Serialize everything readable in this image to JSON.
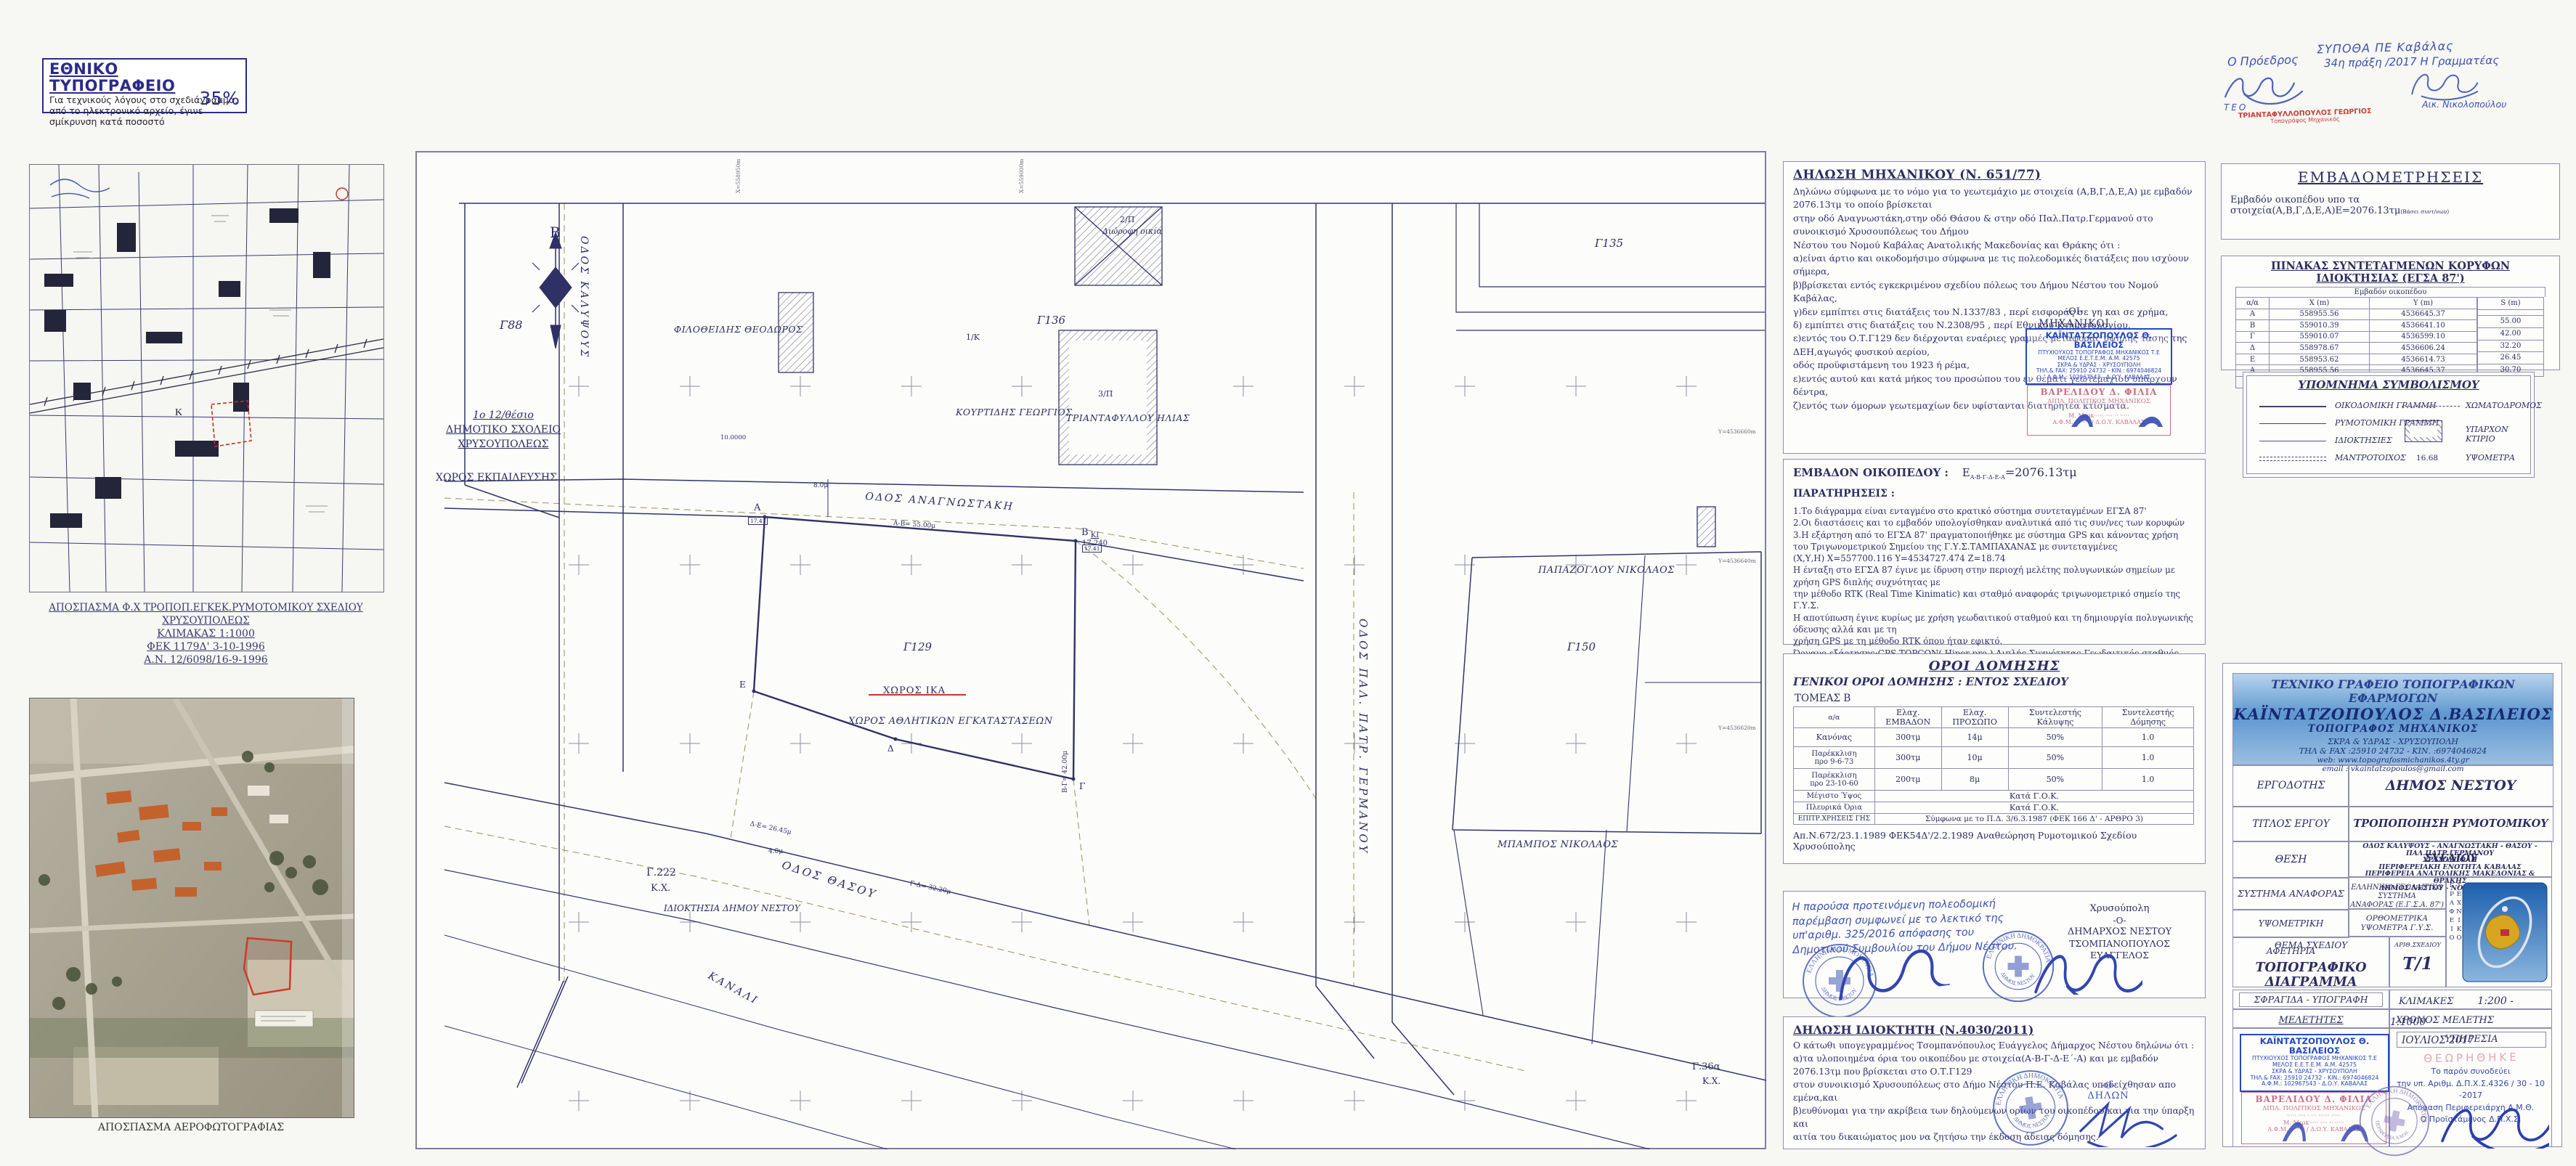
{
  "stamp_note": {
    "title": "ΕΘΝΙΚΟ ΤΥΠΟΓΡΑΦΕΙΟ",
    "line1": "Για τεχνικούς λόγους στο σχεδιάγραμμα,",
    "line2": "από το ηλεκτρονικό αρχείο, έγινε",
    "line3": "σμίκρυνση κατά ποσοστό",
    "percent": "35%"
  },
  "approval": {
    "committee": "ΣΥΠΟΘΑ ΠΕ Καβάλας",
    "act": "34η πράξη /2017 Η Γραμματέας",
    "secretary": "Αικ. Νικολοπούλου",
    "president": "Ο Πρόεδρος",
    "teo": "ΤΕΟ",
    "stamp_name": "ΤΡΙΑΝΤΑΦΥΛΛΟΠΟΥΛΟΣ ΓΕΩΡΓΙΟΣ",
    "stamp_title": "Τοπογράφος Μηχανικός"
  },
  "inset": {
    "caption1": "ΑΠΟΣΠΑΣΜΑ Φ.Χ ΤΡΟΠΟΠ.ΕΓΚΕΚ.ΡΥΜΟΤΟΜΙΚΟΥ ΣΧΕΔΙΟΥ ΧΡΥΣΟΥΠΟΛΕΩΣ",
    "caption2": "ΚΛΙΜΑΚΑΣ 1:1000",
    "caption3": "ΦΕΚ 1179Δ' 3-10-1996",
    "caption4": "Α.Ν. 12/6098/16-9-1996"
  },
  "aerial": {
    "caption": "ΑΠΟΣΠΑΣΜΑ ΑΕΡΟΦΩΤΟΓΡΑΦΙΑΣ"
  },
  "map": {
    "north": "Β",
    "streets": {
      "kalypsous": "ΟΔΟΣ ΚΑΛΥΨΟΥΣ",
      "anagnostaki": "ΟΔΟΣ ΑΝΑΓΝΩΣΤΑΚΗ",
      "thasou": "ΟΔΟΣ ΘΑΣΟΥ",
      "germanou": "ΟΔΟΣ ΠΑΛ. ΠΑΤΡ. ΓΕΡΜΑΝΟΥ",
      "kanali": "ΚΑΝΑΛΙ"
    },
    "blocks": {
      "g88": "Γ88",
      "g129": "Γ129",
      "g135": "Γ135",
      "g136": "Γ136",
      "g150": "Γ150",
      "g222": "Γ.222",
      "g222kx": "Κ.Χ.",
      "g36a": "Γ.36α",
      "g36kx": "Κ.Χ."
    },
    "school": {
      "l1": "1ο 12/θέσιο",
      "l2": "ΔΗΜΟΤΙΚΟ ΣΧΟΛΕΙΟ",
      "l3": "ΧΡΥΣΟΥΠΟΛΕΩΣ",
      "l4": "ΧΩΡΟΣ ΕΚΠΑΙΔΕΥΣΗΣ"
    },
    "owners": {
      "filotheidis": "ΦΙΛΟΘΕΙΔΗΣ ΘΕΟΔΩΡΟΣ",
      "kourtidis": "ΚΟΥΡΤΙΔΗΣ ΓΕΩΡΓΙΟΣ",
      "triantafyllou": "ΤΡΙΑΝΤΑΦΥΛΛΟΥ ΗΛΙΑΣ",
      "papazoglou": "ΠΑΠΑΖΟΓΛΟΥ ΝΙΚΟΛΑΟΣ",
      "mpampos": "ΜΠΑΜΠΟΣ ΝΙΚΟΛΑΟΣ"
    },
    "uses": {
      "ika": "ΧΩΡΟΣ ΙΚΑ",
      "sports": "ΧΩΡΟΣ ΑΘΛΗΤΙΚΩΝ ΕΓΚΑΤΑΣΤΑΣΕΩΝ",
      "municipal": "ΙΔΙΟΚΤΗΣΙΑ ΔΗΜΟΥ ΝΕΣΤΟΥ"
    },
    "house_notes": {
      "n2p": "2/Π",
      "n2p2": "Διώροφη οικία",
      "n3p": "3/Π",
      "n1k": "1/Κ"
    },
    "dims": {
      "ab": "Α-Β= 55.00μ",
      "bg": "Β-Γ= 42.00μ",
      "gd": "Γ-Δ= 32.20μ",
      "de": "Δ-Ε= 26.45μ",
      "w8": "8.0μ",
      "w4": "4.0μ",
      "w10": "10.0000",
      "ki": "ΚΙ",
      "ki_v": "17.240"
    },
    "vertices": {
      "a": "Α",
      "b": "Β",
      "g": "Γ",
      "d": "Δ",
      "e": "Ε",
      "box_a": "17.41",
      "box_b": "17.41"
    },
    "grid": {
      "x1": "Χ=558950m",
      "x2": "Χ=559000m",
      "y1": "Υ=4536660m",
      "y2": "Υ=4536640m",
      "y3": "Υ=4536620m"
    }
  },
  "engineer": {
    "title": "ΔΗΛΩΣΗ ΜΗΧΑΝΙΚΟΥ  (Ν. 651/77)",
    "paragraphs": [
      "Δηλώνω σύμφωνα με το νόμο για το γεωτεμάχιο με στοιχεία (Α,Β,Γ,Δ,Ε,Α) με εμβαδόν 2076.13τμ το οποίο βρίσκεται",
      "στην οδό Αναγνωστάκη,στην οδό Θάσου & στην οδό Παλ.Πατρ.Γερμανού στο συνοικισμό Χρυσουπόλεως του Δήμου",
      "Νέστου του Νομού Καβάλας Ανατολικής Μακεδονίας και Θράκης ότι :",
      "α)είναι άρτιο και οικοδομήσιμο σύμφωνα με τις πολεοδομικές διατάξεις που ισχύουν σήμερα,",
      "β)βρίσκεται εντός εγκεκριμένου σχεδίου πόλεως του Δήμου Νέστου του Νομού Καβάλας,",
      "γ)δεν εμπίπτει στις διατάξεις του Ν.1337/83 , περί εισφοράς σε γη και σε χρήμα,",
      "δ) εμπίπτει στις διατάξεις του Ν.2308/95 , περί Εθνικού Κτηματολογίου,",
      "ε)εντός του Ο.Τ.Γ129 δεν διέρχονται εναέριες γραμμές μεταφοράς υψηλής τάσης της ΔΕΗ,αγωγός φυσικού αερίου,",
      "οδός προϋφιστάμενη του 1923 ή ρέμα,",
      "ε)εντός αυτού και κατά μήκος του προσώπου του εν θέματι γεωτεμαχίου υπάρχουν δέντρα,",
      "ζ)εντός των όμορων γεωτεμαχίων δεν υφίστανται διατηρητέα κτίσματα."
    ],
    "oi": "-ΟΙ-",
    "mixanikoi": "ΜΗΧΑΝΙΚΟΙ"
  },
  "stamps": {
    "blue": {
      "name": "ΚΑΪΝΤΑΤΖΟΠΟΥΛΟΣ Θ. ΒΑΣΙΛΕΙΟΣ",
      "l2": "ΠΤΥΧΙΟΥΧΟΣ ΤΟΠΟΓΡΑΦΟΣ ΜΗΧΑΝΙΚΟΣ Τ.Ε",
      "l3": "ΜΕΛΟΣ Ε.Ε.Τ.Ε.Μ.   Α.Μ. 42575",
      "l4": "ΣΚΡΑ & ΥΔΡΑΣ - ΧΡΥΣΟΥΠΟΛΗ",
      "l5": "ΤΗΛ.& FAX: 25910 24732 - ΚΙΝ.: 6974046824",
      "l6": "Α.Φ.Μ.: 102967543  -  Δ.Ο.Υ. ΚΑΒΑΛΑΣ"
    },
    "pink": {
      "name": "ΒΑΡΕΛΙΔΟΥ Δ. ΦΙΛΙΑ",
      "l2": "ΔΙΠΛ. ΠΟΛΙΤΙΚΟΣ ΜΗΧΑΝΙΚΟΣ",
      "l3": "····· ···· · ··· ······ ·····",
      "l4": "Μ. Μερκ····· ···· ·· ·····",
      "l5": "Α.Φ.Μ. ········ / Δ.Ο.Υ. ΚΑΒΑΛΑΣ"
    },
    "round": {
      "outer": "ΕΛΛΗΝΙΚΗ ΔΗΜΟΚΡΑΤΙΑ",
      "inner": "ΔΗΜΟΣ ΝΕΣΤΟΥ"
    },
    "region": {
      "outer": "ΕΛΛΗΝΙΚΗ ΔΗΜΟΚΡΑΤΙΑ",
      "inner": "ΠΕΡΙΦΕΡΕΙΑ Α.Μ.Θ."
    }
  },
  "area": {
    "heading": "ΕΜΒΑΔΟΝ ΟΙΚΟΠΕΔΟΥ :",
    "e": "Ε",
    "sub": "Α-Β-Γ-Δ-Ε-Α",
    "value": "=2076.13τμ",
    "par": "ΠΑΡΑΤΗΡΗΣΕΙΣ :",
    "notes": [
      "1.Το διάγραμμα είναι ενταγμένο στο κρατικό σύστημα συντεταγμένων ΕΓΣΑ 87'",
      "2.Οι διαστάσεις και το εμβαδόν υπολογίσθηκαν αναλυτικά από τις συν/νες των κορυφών",
      "3.Η εξάρτηση από το ΕΓΣΑ 87' πραγματοποιήθηκε με σύστημα GPS και κάνοντας χρήση",
      "του Τριγωνομετρικού Σημείου της Γ.Υ.Σ.ΤΑΜΠΑΧΑΝΑΣ  με συντεταγμένες",
      "(Χ,Υ,Η) Χ=557700.116   Υ=4534727.474   Ζ=18.74",
      "Η ένταξη στο ΕΓΣΑ 87 έγινε με ίδρυση στην περιοχή μελέτης πολυγωνικών σημείων με χρήση GPS διπλής συχνότητας με",
      "την μέθοδο RTK (Real Time Kinimatic) και σταθμό αναφοράς τριγωνομετρικό σημείο της Γ.Υ.Σ.",
      "Η αποτύπωση έγινε κυρίως με χρήση γεωδαιτικού σταθμού και τη δημιουργία πολυγωνικής όδευσης αλλά και με τη",
      "χρήση GPS με τη μέθοδο RTK όπου ήταν εφικτό.",
      "Όργανο εξάρτησης:GPS TOPCON( Hiper pro ) Διπλής Συχνότητας-Γεωδαιτικός σταθμός TOPCON GPT 3105N"
    ]
  },
  "terms": {
    "title": "ΟΡΟΙ ΔΟΜΗΣΗΣ",
    "subtitle": "ΓΕΝΙΚΟΙ ΟΡΟΙ ΔΟΜΗΣΗΣ : ΕΝΤΟΣ ΣΧΕΔΙΟΥ",
    "sector": "ΤΟΜΕΑΣ Β",
    "h": [
      "α/α",
      "Ελαχ. ΕΜΒΑΔΟΝ",
      "Ελαχ. ΠΡΟΣΩΠΟ",
      "Συντελεστής Κάλυψης",
      "Συντελεστής Δόμησης"
    ],
    "r1": [
      "Κανόνας",
      "300τμ",
      "14μ",
      "50%",
      "1.0"
    ],
    "r2a": "Παρέκκλιση",
    "r2b": "προ 9-6-73",
    "r2": [
      "300τμ",
      "10μ",
      "50%",
      "1.0"
    ],
    "r3a": "Παρέκκλιση",
    "r3b": "προ 23-10-60",
    "r3": [
      "200τμ",
      "8μ",
      "50%",
      "1.0"
    ],
    "s1l": "Μέγιστο Ύψος",
    "s1v": "Κατά Γ.Ο.Κ.",
    "s2l": "Πλευρικά Όρια",
    "s2v": "Κατά Γ.Ο.Κ.",
    "s3l": "ΕΠΙΤΡ.ΧΡΗΣΕΙΣ ΓΗΣ",
    "s3v": "Σύμφωνα με το Π.Δ. 3/6.3.1987 (ΦΕΚ 166 Δ' - ΑΡΘΡΟ 3)",
    "footnote": "Απ.Ν.672/23.1.1989 ΦΕΚ54Δ'/2.2.1989 Αναθεώρηση Ρυμοτομικού Σχεδίου Χρυσούπολης"
  },
  "council": {
    "lines": [
      "Η παρούσα προτεινόμενη πολεοδομική",
      "παρέμβαση συμφωνεί με το λεκτικό της",
      "υπ'αριθμ. 325/2016 απόφασης του",
      "Δημοτικού Συμβουλίου του Δήμου Νέστου."
    ],
    "city": "Χρυσούπολη",
    "o": "-Ο-",
    "mayor_title": "ΔΗΜΑΡΧΟΣ ΝΕΣΤΟΥ",
    "mayor": "ΤΣΟΜΠΑΝΟΠΟΥΛΟΣ ΕΥΑΓΓΕΛΟΣ"
  },
  "owner": {
    "title": "ΔΗΛΩΣΗ  ΙΔΙΟΚΤΗΤΗ (Ν.4030/2011)",
    "lines": [
      "Ο κάτωθι υπογεγραμμένος Τσομπανόπουλος Ευάγγελος Δήμαρχος Νέστου δηλώνω ότι :",
      "α)τα υλοποιημένα όρια του οικοπέδου με στοιχεία(Α-Β-Γ-Δ-Ε΄-Α) και με εμβαδόν 2076.13τμ που βρίσκεται στο Ο.Τ.Γ129",
      "στον συνοικισμό Χρυσουπόλεως στο Δήμο Νέστου Π.Ε. Καβάλας υποδείχθησαν απο εμένα,και",
      "β)ευθύνομαι για την ακρίβεια των δηλούμενων ορίων του οικοπέδου και για την ύπαρξη και",
      "αιτία του δικαιώματος μου να ζητήσω την έκδοση άδειας δόμησης."
    ],
    "o": "-Ο-",
    "declarant": "ΔΗΛΩΝ"
  },
  "embado": {
    "title": "ΕΜΒΑΔΟΜΕΤΡΗΣΕΙΣ",
    "line": "Εμβαδόν οικοπέδου υπο τα στοιχεία(Α,Β,Γ,Δ,Ε,Α)Ε=2076.13τμ",
    "small": "(Βάσει συντ/νων)"
  },
  "coords": {
    "title": "ΠΙΝΑΚΑΣ ΣΥΝΤΕΤΑΓΜΕΝΩΝ ΚΟΡΥΦΩΝ ΙΔΙΟΚΤΗΣΙΑΣ (ΕΓΣΑ 87')",
    "subtitle": "Εμβαδόν οικοπέδου",
    "h": [
      "α/α",
      "X (m)",
      "Y (m)",
      "S (m)"
    ],
    "rows": [
      [
        "Α",
        "558955.56",
        "4536645.37"
      ],
      [
        "Β",
        "559010.39",
        "4536641.10"
      ],
      [
        "Γ",
        "559010.07",
        "4536599.10"
      ],
      [
        "Δ",
        "558978.67",
        "4536606.24"
      ],
      [
        "Ε",
        "558953.62",
        "4536614.73"
      ],
      [
        "Α",
        "558955.56",
        "4536645.37"
      ]
    ],
    "s": [
      "55.00",
      "42.00",
      "32.20",
      "26.45",
      "30.70"
    ],
    "total": "Ε = 2076.13τ.μ."
  },
  "legend": {
    "title": "ΥΠΟΜΝΗΜΑ ΣΥΜΒΟΛΙΣΜΟΥ",
    "i1": "ΟΙΚΟΔΟΜΙΚΗ ΓΡΑΜΜΗ",
    "i2": "ΡΥΜΟΤΟΜΙΚΗ ΓΡΑΜΜΗ",
    "i3": "ΙΔΙΟΚΤΗΣΙΕΣ",
    "i4": "ΜΑΝΤΡΟΤΟΙΧΟΣ",
    "i5": "ΧΩΜΑΤΟΔΡΟΜΟΣ",
    "i6": "ΥΠΑΡΧΟΝ ΚΤΙΡΙΟ",
    "i7v": "16.68",
    "i7": "ΥΨΟΜΕΤΡΑ"
  },
  "tb": {
    "o1": "ΤΕΧΝΙΚΟ ΓΡΑΦΕΙΟ ΤΟΠΟΓΡΑΦΙΚΩΝ ΕΦΑΡΜΟΓΩΝ",
    "o2": "ΚΑΪΝΤΑΤΖΟΠΟΥΛΟΣ Δ.ΒΑΣΙΛΕΙΟΣ",
    "o3": "ΤΟΠΟΓΡΑΦΟΣ ΜΗΧΑΝΙΚΟΣ",
    "o4": "ΣΚΡΑ & ΥΔΡΑΣ - ΧΡΥΣΟΥΠΟΛΗ",
    "o5": "ΤΗΛ & FAX :25910 24732 - ΚΙΝ. :6974046824",
    "o6": "web: www.topografosmichanikos.4ty.gr",
    "o7": "email : vkaintatzopoulos@gmail.com",
    "ergodotis": "ΕΡΓΟΔΟΤΗΣ",
    "ergodotis_v": "ΔΗΜΟΣ ΝΕΣΤΟΥ",
    "titlos": "ΤΙΤΛΟΣ ΕΡΓΟΥ",
    "titlos_v": "ΤΡΟΠΟΠΟΙΗΣΗ ΡΥΜΟΤΟΜΙΚΟΥ ΣΧΕΔΙΟΥ",
    "thesi": "ΘΕΣΗ",
    "thesi_lines": [
      "ΟΔΟΣ  ΚΑΛΥΨΟΥΣ - ΑΝΑΓΝΩΣΤΑΚΗ - ΘΑΣΟΥ - ΠΑΛ.ΠΑΤΡ.ΓΕΡΜΑΝΟΥ",
      "ΧΡΥΣΟΥΠΟΛΗ",
      "ΠΕΡΙΦΕΡΕΙΑΚΗ ΕΝΟΤΗΤΑ ΚΑΒΑΛΑΣ",
      "ΠΕΡΙΦΕΡΕΙΑ ΑΝΑΤΟΛΙΚΗΣ ΜΑΚΕΔΟΝΙΑΣ & ΘΡΑΚΗΣ",
      "ΔΗΜΟΣ ΝΕΣΤΟΥ - ΝΟΜΟΣ ΚΑΒΑΛΑΣ"
    ],
    "systima": "ΣΥΣΤΗΜΑ ΑΝΑΦΟΡΑΣ",
    "systima_v1": "ΕΛΛΗΝΙΚΟ ΓΕΩΔΑΙΤΙΚΟ ΣΥΣΤΗΜΑ",
    "systima_v2": "ΑΝΑΦΟΡΑΣ (Ε.Γ.Σ.Α. 87')",
    "ypsometriki": "ΥΨΟΜΕΤΡΙΚΗ ΑΦΕΤΗΡΙΑ",
    "ypsometriki_v1": "ΟΡΘΟΜΕΤΡΙΚΑ",
    "ypsometriki_v2": "ΥΨΟΜΕΤΡΑ Γ.Υ.Σ.",
    "thema": "ΘΕΜΑ ΣΧΕΔΙΟΥ",
    "thema_v": "ΤΟΠΟΓΡΑΦΙΚΟ ΔΙΑΓΡΑΜΜΑ",
    "arith": "ΑΡΙΘ.ΣΧΕΔΙΟΥ",
    "arith_v": "Τ/1",
    "sfragida": "ΣΦΡΑΓΙΔΑ - ΥΠΟΓΡΑΦΗ",
    "klimakes": "ΚΛΙΜΑΚΕΣ",
    "klimakes_v": "1:200 - 1:1000",
    "meletites": "ΜΕΛΕΤΗΤΕΣ",
    "xronos": "ΧΡΟΝΟΣ ΜΕΛΕΤΗΣ",
    "xronos_v": "ΙΟΥΛΙΟΣ  2017",
    "ypiresia": "ΥΠΗΡΕΣΙΑ",
    "theorithike": "ΘΕΩΡΗΘΗΚΕ",
    "service_lines": [
      "Το παρόν συνοδεύει",
      "την υπ. Αριθμ. Δ.Π.Χ.Σ.4326 / 30 - 10 -2017",
      "Απόφαση Περιφερειάρχη Α.Μ.Θ.",
      "Ο Προϊστάμενος Δ.Π.Χ.Σ."
    ],
    "logo_side": "ΤΕΧΝΙΚΟ ΓΡΑΦΕΙΟ"
  }
}
